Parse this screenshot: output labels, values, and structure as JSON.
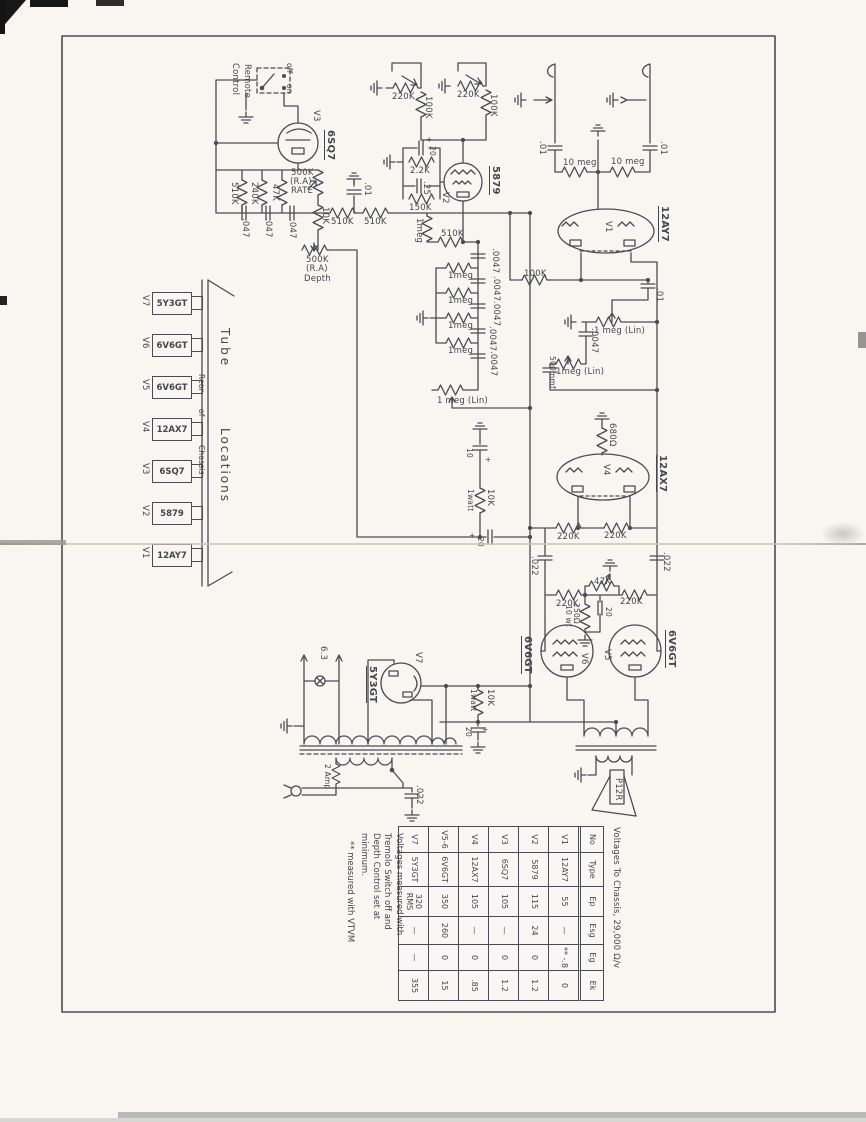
{
  "osc": {
    "remote1": "Remote",
    "remote2": "Control",
    "off": "off",
    "on": "on",
    "v3": "V3",
    "v3_type": "6SQ7",
    "r1": "510K",
    "r2": "240K",
    "r3": "47K",
    "c1": ".047",
    "c2": ".047",
    "c3": ".047",
    "r4": "10K",
    "rate1": "500K",
    "rate2": "(R.A)",
    "rate3": "RATE",
    "depth1": "500K",
    "depth2": "(R.A)",
    "depth3": "Depth",
    "r5": "510K",
    "r6": "510K",
    "c4": ".01"
  },
  "inputs": {
    "r1": "220K",
    "g1": "100K",
    "r2": "220K",
    "g2": "100K"
  },
  "pre": {
    "v2": "V2",
    "type": "5879",
    "c1": "20",
    "plus": "+",
    "r1": "2.2K",
    "c2": ".25",
    "r2": "150K",
    "r3": "1meg",
    "r4": "510K"
  },
  "lad": {
    "c1": ".0047",
    "c2": ".0047",
    "c3": ".0047",
    "c4": ".0047",
    "c5": ".0047",
    "r1": "1meg",
    "r2": "1meg",
    "r3": "1meg",
    "r4": "1meg",
    "pot": "1 meg (Lin)"
  },
  "ch2": {
    "c1": ".01",
    "c2": ".01",
    "r1": "10 meg",
    "r2": "10 meg",
    "v1": "V1",
    "type": "12AY7",
    "r3": "100K"
  },
  "trem": {
    "c1": ".01",
    "pot1": "1 meg (Lin)",
    "c2": ".0047",
    "pot2": "1meg (Lin)",
    "c3": "500mmf"
  },
  "drv": {
    "v4": "V4",
    "type": "12AX7",
    "rk": "680Ω",
    "r1": "220K",
    "r2": "220K",
    "c1": ".022",
    "c2": ".022"
  },
  "out": {
    "pot": "47K",
    "r1": "220K",
    "r2": "220K",
    "rk": "250Ω",
    "rw": "10 wt",
    "c": "20",
    "v5": "V5",
    "v6": "V6",
    "t5": "6V6GT",
    "t6": "6V6GT",
    "spk": "P12R"
  },
  "ps": {
    "v7": "V7",
    "type": "5Y3GT",
    "heat": "6.3",
    "fuse": "2 Amp",
    "c1": ".022",
    "r": "10K",
    "rw": "1watt",
    "c2": "20",
    "plus": "+"
  },
  "filt": {
    "c1": "10",
    "p1": "+",
    "r": "10K",
    "rw": "1watt",
    "c2": "20",
    "p2": "+"
  },
  "chart": {
    "t1": "Tube",
    "t2": "Locations",
    "s1": "Rear",
    "s2": "of",
    "s3": "Chassis",
    "rows": [
      {
        "no": "V7",
        "type": "5Y3GT"
      },
      {
        "no": "V6",
        "type": "6V6GT"
      },
      {
        "no": "V5",
        "type": "6V6GT"
      },
      {
        "no": "V4",
        "type": "12AX7"
      },
      {
        "no": "V3",
        "type": "6SQ7"
      },
      {
        "no": "V2",
        "type": "5879"
      },
      {
        "no": "V1",
        "type": "12AY7"
      }
    ]
  },
  "vt": {
    "title": "Voltages To Chassis, 29,000 Ω/v",
    "headers": [
      "No",
      "Type",
      "Ep",
      "Esg",
      "Eg",
      "Ek"
    ],
    "rows": [
      [
        "V1",
        "12AY7",
        "55",
        "—",
        "** -.8",
        "0"
      ],
      [
        "V2",
        "5879",
        "115",
        "24",
        "0",
        "1.2"
      ],
      [
        "V3",
        "6SQ7",
        "105",
        "—",
        "0",
        "1.2"
      ],
      [
        "V4",
        "12AX7",
        "105",
        "—",
        "0",
        ".85"
      ],
      [
        "V5-6",
        "6V6GT",
        "350",
        "260",
        "0",
        "15"
      ],
      [
        "V7",
        "5Y3GT",
        "320 RMS",
        "—",
        "—",
        "355"
      ]
    ],
    "notes": [
      "Voltages measured with",
      "Tremolo Switch off and",
      "Depth Control set at",
      "minimum."
    ],
    "mark": "**",
    "vtvm": "measured with VTVM"
  }
}
